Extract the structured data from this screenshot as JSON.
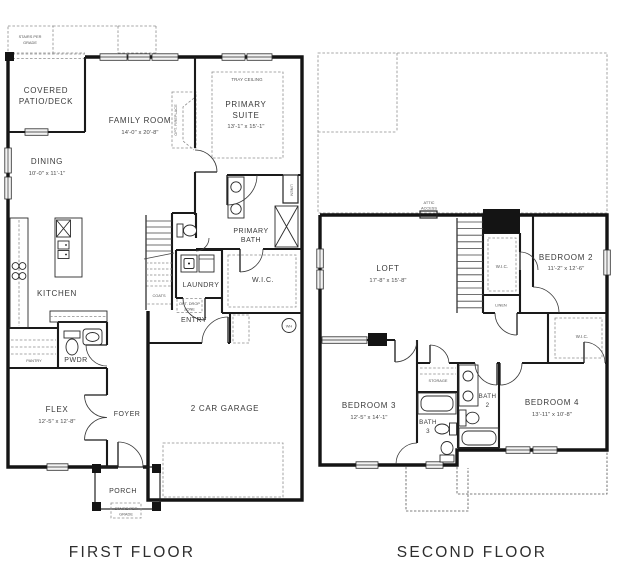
{
  "colors": {
    "background": "#ffffff",
    "wall": "#141414",
    "text": "#3a3a3a",
    "dashed_line": "#8d8d8d",
    "window_fill": "#f3f3f3"
  },
  "first_floor": {
    "title": "FIRST FLOOR",
    "labels": {
      "stairs_grade_top_1": "STAIRS PER",
      "stairs_grade_top_2": "GRADE",
      "covered_patio_1": "COVERED",
      "covered_patio_2": "PATIO/DECK",
      "family_room": "FAMILY ROOM",
      "family_room_dims": "14'-0\" x 20'-8\"",
      "opt_fireplace": "OPT. FIREPLACE",
      "tray_ceiling": "TRAY CEILING",
      "primary_suite_1": "PRIMARY",
      "primary_suite_2": "SUITE",
      "primary_suite_dims": "13'-1\" x 15'-1\"",
      "dining": "DINING",
      "dining_dims": "10'-0\" x 11'-1\"",
      "linen": "LINEN",
      "primary_bath_1": "PRIMARY",
      "primary_bath_2": "BATH",
      "laundry": "LAUNDRY",
      "wic": "W.I.C.",
      "coats": "COATS",
      "kitchen": "KITCHEN",
      "opt_drop_1": "OPT. DROP",
      "opt_drop_2": "ZONE",
      "entry": "ENTRY",
      "pantry": "PANTRY",
      "pwdr": "PWDR",
      "wh": "WH",
      "flex": "FLEX",
      "flex_dims": "12'-5\" x 12'-8\"",
      "foyer": "FOYER",
      "garage": "2 CAR GARAGE",
      "porch": "PORCH",
      "stairs_grade_bottom_1": "STAIRS PER",
      "stairs_grade_bottom_2": "GRADE"
    }
  },
  "second_floor": {
    "title": "SECOND FLOOR",
    "labels": {
      "attic_1": "ATTIC",
      "attic_2": "ACCESS",
      "loft": "LOFT",
      "loft_dims": "17'-8\" x 15'-8\"",
      "wic_center": "W.I.C.",
      "linen": "LINEN",
      "bedroom2": "BEDROOM 2",
      "bedroom2_dims": "11'-2\" x 12'-6\"",
      "wic_right": "W.I.C.",
      "storage": "STORAGE",
      "bath2_1": "BATH",
      "bath2_2": "2",
      "bedroom3": "BEDROOM 3",
      "bedroom3_dims": "12'-5\" x 14'-1\"",
      "bath3_1": "BATH",
      "bath3_2": "3",
      "bedroom4": "BEDROOM 4",
      "bedroom4_dims": "13'-11\" x 10'-8\"",
      "bath2_full": "BATH 2",
      "bath3_full": "BATH 3"
    }
  }
}
